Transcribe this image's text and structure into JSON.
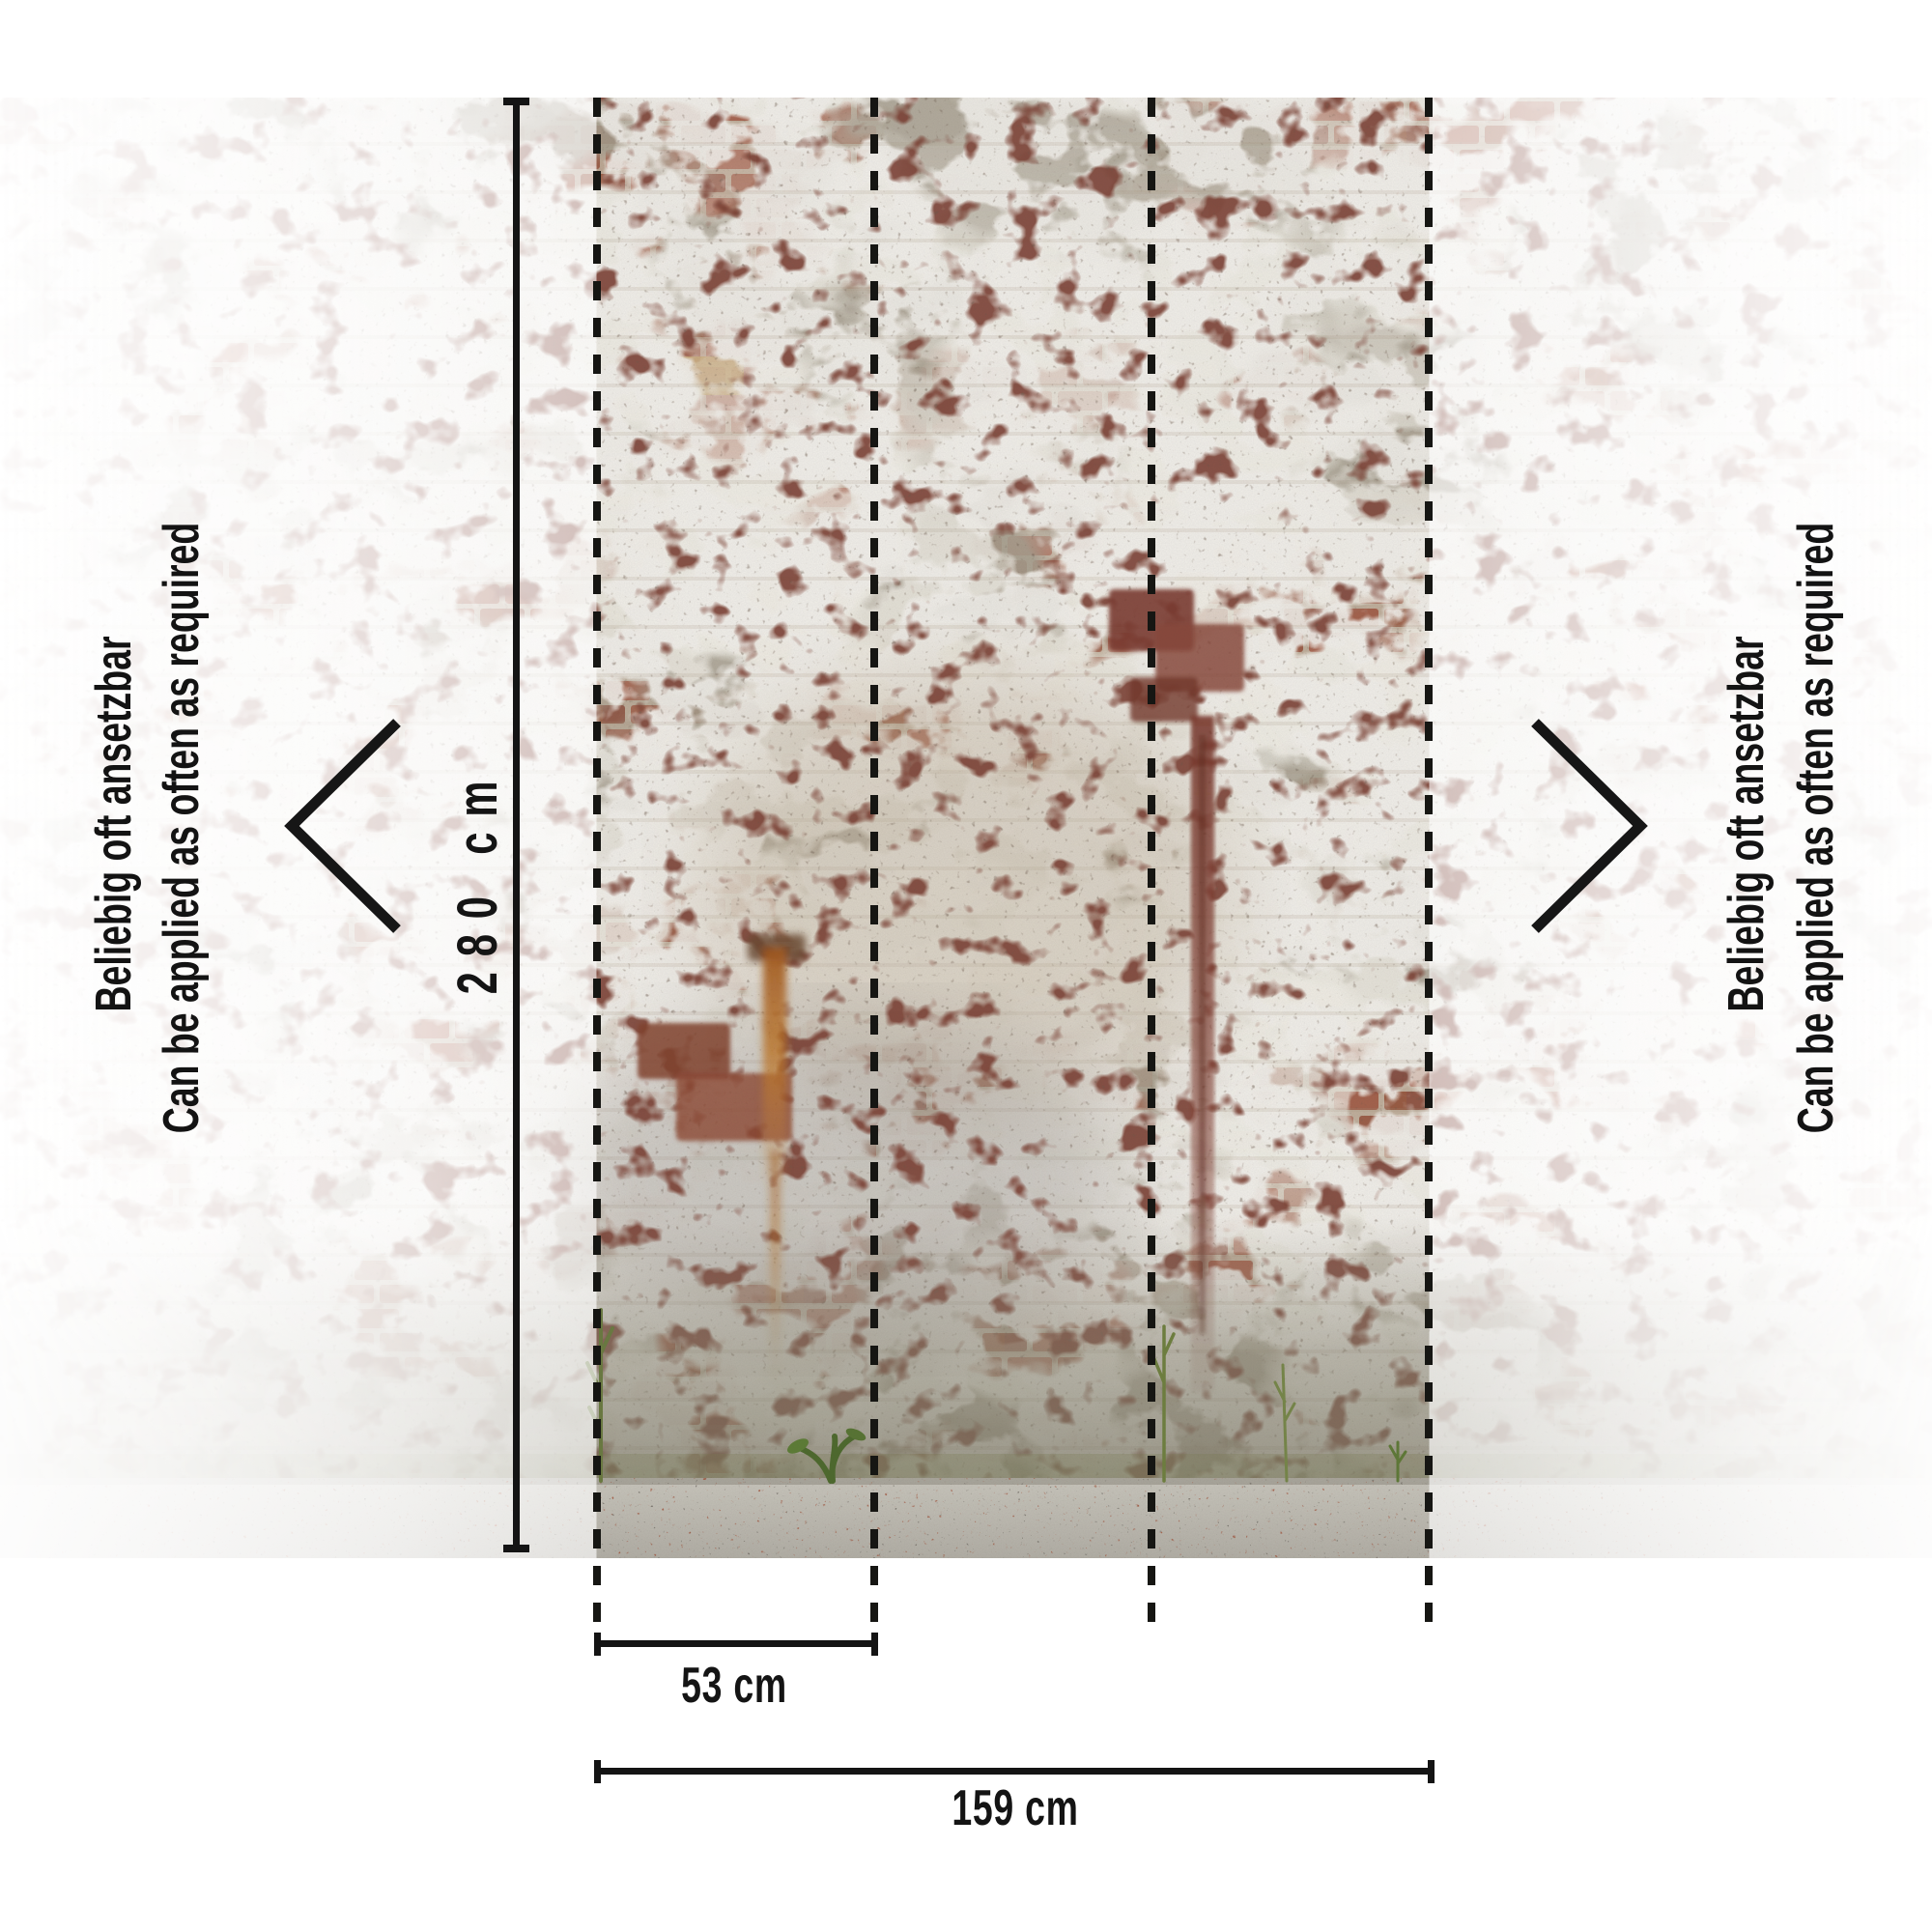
{
  "product": {
    "kind": "wall-mural-application-diagram"
  },
  "side_notes": {
    "de": "Beliebig oft ansetzbar",
    "en": "Can be applied as often as required"
  },
  "dimensions": {
    "height_label": "280 cm",
    "panel_width_label": "53 cm",
    "total_width_label": "159 cm"
  },
  "panels": {
    "seam_count": 4,
    "style": "dashed"
  },
  "colors": {
    "annotation_ink": "#141414",
    "background": "#ffffff",
    "brick_red": "#a05c46",
    "maroon_chip": "#7c4236",
    "plaster_white": "#ece8e1",
    "mortar_tan": "#c9b8a6",
    "concrete_gray": "#9a948a",
    "dark_band": "#85816f",
    "ground_gray": "#bcb9b0",
    "rust_orange": "#c0782a",
    "weed_green": "#5e7436"
  }
}
